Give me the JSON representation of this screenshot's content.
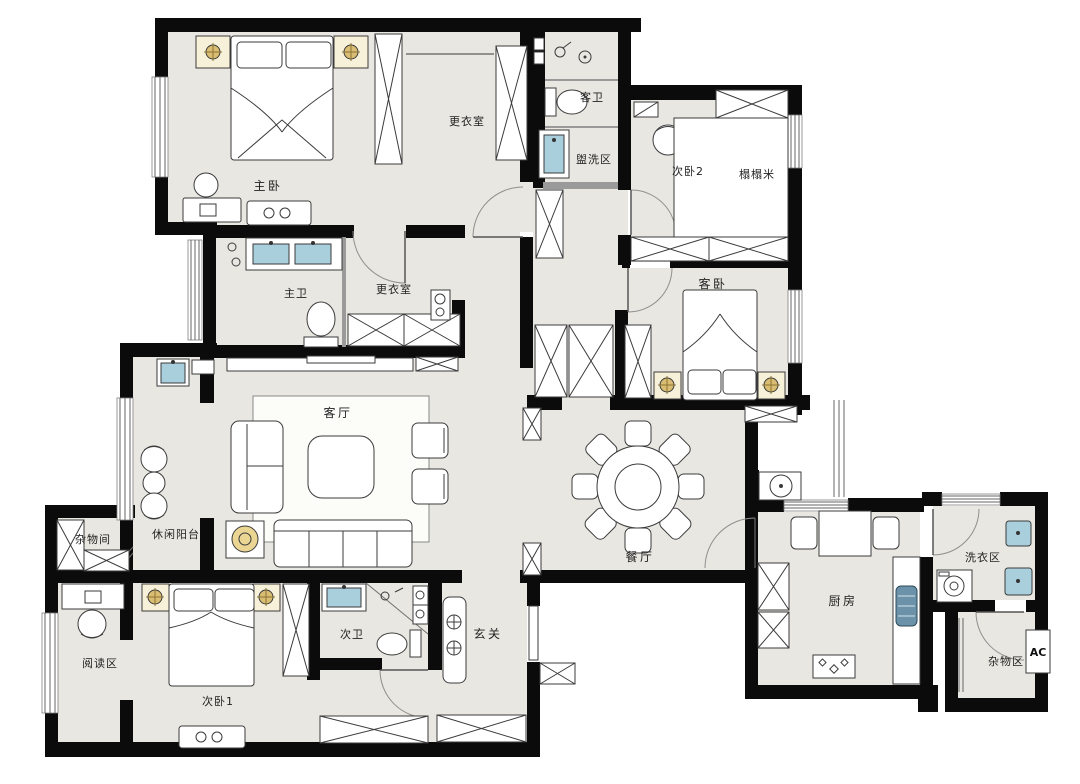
{
  "plan": {
    "kind": "apartment-floor-plan",
    "colors": {
      "wall": "#0b0b0b",
      "floor": "#e9e7e1",
      "lamp_gold": "#d9bd72",
      "lamp_gold_light": "#ead593",
      "cabinet_cream": "#f8f1da",
      "sink_blue": "#a9cfdd",
      "fridge_blue": "#6b92a8"
    },
    "rooms": [
      {
        "id": "master-bedroom",
        "label": "主卧"
      },
      {
        "id": "closet-top",
        "label": "更衣室"
      },
      {
        "id": "guest-bath",
        "label": "客卫"
      },
      {
        "id": "wash-area",
        "label": "盥洗区"
      },
      {
        "id": "bedroom-2",
        "label": "次卧2"
      },
      {
        "id": "tatami",
        "label": "榻榻米"
      },
      {
        "id": "master-bath",
        "label": "主卫"
      },
      {
        "id": "closet-2",
        "label": "更衣室"
      },
      {
        "id": "guest-bedroom",
        "label": "客卧"
      },
      {
        "id": "living-room",
        "label": "客厅"
      },
      {
        "id": "leisure-balcony",
        "label": "休闲阳台"
      },
      {
        "id": "storage-room",
        "label": "杂物间"
      },
      {
        "id": "dining-room",
        "label": "餐厅"
      },
      {
        "id": "reading-area",
        "label": "阅读区"
      },
      {
        "id": "bedroom-1",
        "label": "次卧1"
      },
      {
        "id": "bath-2",
        "label": "次卫"
      },
      {
        "id": "entry",
        "label": "玄关"
      },
      {
        "id": "kitchen",
        "label": "厨房"
      },
      {
        "id": "laundry-area",
        "label": "洗衣区"
      },
      {
        "id": "storage-area",
        "label": "杂物区"
      },
      {
        "id": "ac-platform",
        "label": "AC"
      }
    ]
  }
}
